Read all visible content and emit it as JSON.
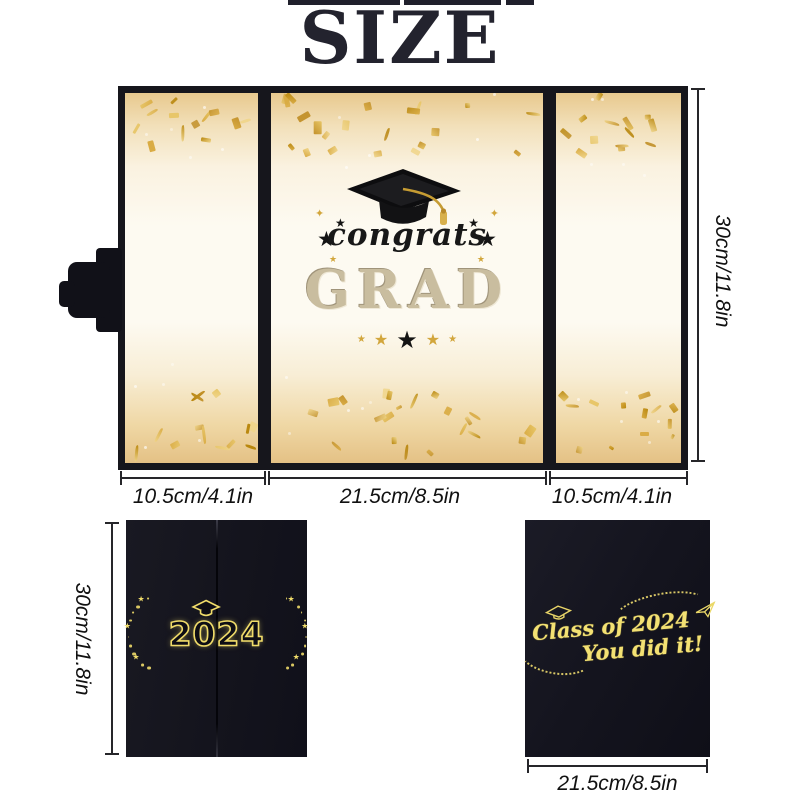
{
  "title": "SIZE",
  "colors": {
    "gold": "#d2a63c",
    "gold_bright": "#f0dc6a",
    "card_black": "#14141d",
    "ink": "#23232e",
    "cream": "#fdfaf1",
    "champagne": "#c9bd9f"
  },
  "trifold": {
    "congrats": "congrats",
    "grad": "GRAD",
    "star": "★",
    "sparkle": "✦",
    "dims": {
      "height": "30cm/11.8in",
      "left_panel": "10.5cm/4.1in",
      "center_panel": "21.5cm/8.5in",
      "right_panel": "10.5cm/4.1in"
    }
  },
  "front_card": {
    "year": "2024",
    "height": "30cm/11.8in"
  },
  "back_card": {
    "line1": "Class of 2024",
    "line2": "You did it!",
    "width": "21.5cm/8.5in"
  }
}
